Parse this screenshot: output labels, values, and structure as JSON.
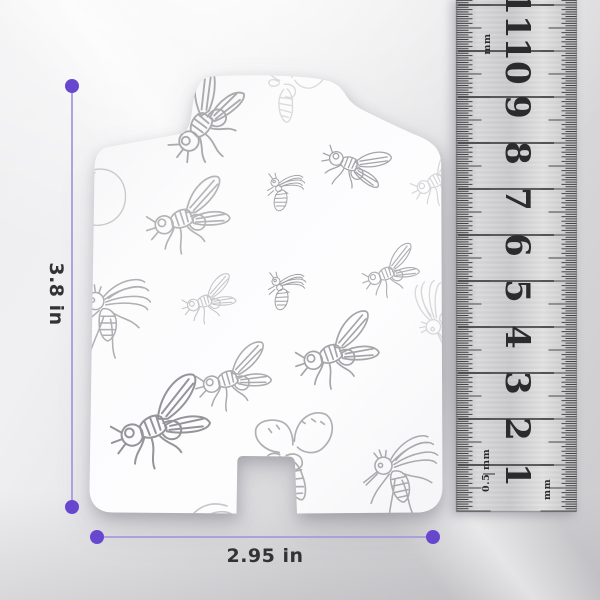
{
  "scene": {
    "description": "White insect-pattern trap refill card with measurement annotations and metal ruler"
  },
  "dimensions": {
    "height": {
      "label": "3.8 in"
    },
    "width": {
      "label": "2.95 in"
    }
  },
  "colors": {
    "accent_dot": "#6847cf",
    "accent_line": "#a59bdc",
    "label_text": "#333336",
    "sketch_line": "#8f8f94"
  },
  "ruler": {
    "numbers": [
      1,
      2,
      3,
      4,
      5,
      6,
      7,
      8,
      9,
      10,
      11
    ],
    "top_unit_label": "mm",
    "bottom_left_value": "0.5",
    "bottom_left_unit": "mm",
    "bottom_right_unit": "mm",
    "zero_y": 511,
    "px_per_cm": 46,
    "left_edge": 456.5,
    "right_edge": 576.5,
    "number_x": 517
  },
  "card": {
    "pattern": "hand-sketched flies, bees, mosquitoes and moths",
    "illustrations": [
      {
        "type": "fly",
        "cx": 210,
        "cy": 116,
        "s": 1.15,
        "r": -40,
        "o": 0.75
      },
      {
        "type": "moth",
        "cx": 292,
        "cy": 92,
        "s": 0.85,
        "r": 6,
        "o": 0.3
      },
      {
        "type": "fly",
        "cx": 357,
        "cy": 168,
        "s": 0.8,
        "r": 35,
        "o": 0.8
      },
      {
        "type": "fly",
        "cx": 443,
        "cy": 178,
        "s": 0.75,
        "r": -15,
        "o": 0.35
      },
      {
        "type": "mosquito",
        "cx": 451,
        "cy": 306,
        "s": 0.8,
        "r": -90,
        "o": 0.33
      },
      {
        "type": "blob",
        "cx": 100,
        "cy": 198,
        "s": 0.85,
        "r": 0,
        "o": 0.45
      },
      {
        "type": "fly",
        "cx": 193,
        "cy": 217,
        "s": 1.05,
        "r": -5,
        "o": 0.65
      },
      {
        "type": "bee",
        "cx": 288,
        "cy": 201,
        "s": 0.62,
        "r": 0,
        "o": 0.8
      },
      {
        "type": "fly",
        "cx": 212,
        "cy": 300,
        "s": 0.68,
        "r": -5,
        "o": 0.5
      },
      {
        "type": "bee",
        "cx": 289,
        "cy": 300,
        "s": 0.62,
        "r": 0,
        "o": 0.85
      },
      {
        "type": "fly",
        "cx": 394,
        "cy": 272,
        "s": 0.72,
        "r": -8,
        "o": 0.7
      },
      {
        "type": "mosquito",
        "cx": 120,
        "cy": 322,
        "s": 0.95,
        "r": 0,
        "o": 0.7
      },
      {
        "type": "fly",
        "cx": 238,
        "cy": 378,
        "s": 0.95,
        "r": -3,
        "o": 0.75
      },
      {
        "type": "fly",
        "cx": 342,
        "cy": 352,
        "s": 1.05,
        "r": -6,
        "o": 0.8
      },
      {
        "type": "fly",
        "cx": 166,
        "cy": 424,
        "s": 1.25,
        "r": -8,
        "o": 0.95
      },
      {
        "type": "moth",
        "cx": 298,
        "cy": 462,
        "s": 1.05,
        "r": -10,
        "o": 0.7
      },
      {
        "type": "mosquito",
        "cx": 412,
        "cy": 481,
        "s": 0.95,
        "r": -12,
        "o": 0.75
      },
      {
        "type": "leaf",
        "cx": 193,
        "cy": 504,
        "s": 1.0,
        "r": 0,
        "o": 0.5
      }
    ]
  }
}
